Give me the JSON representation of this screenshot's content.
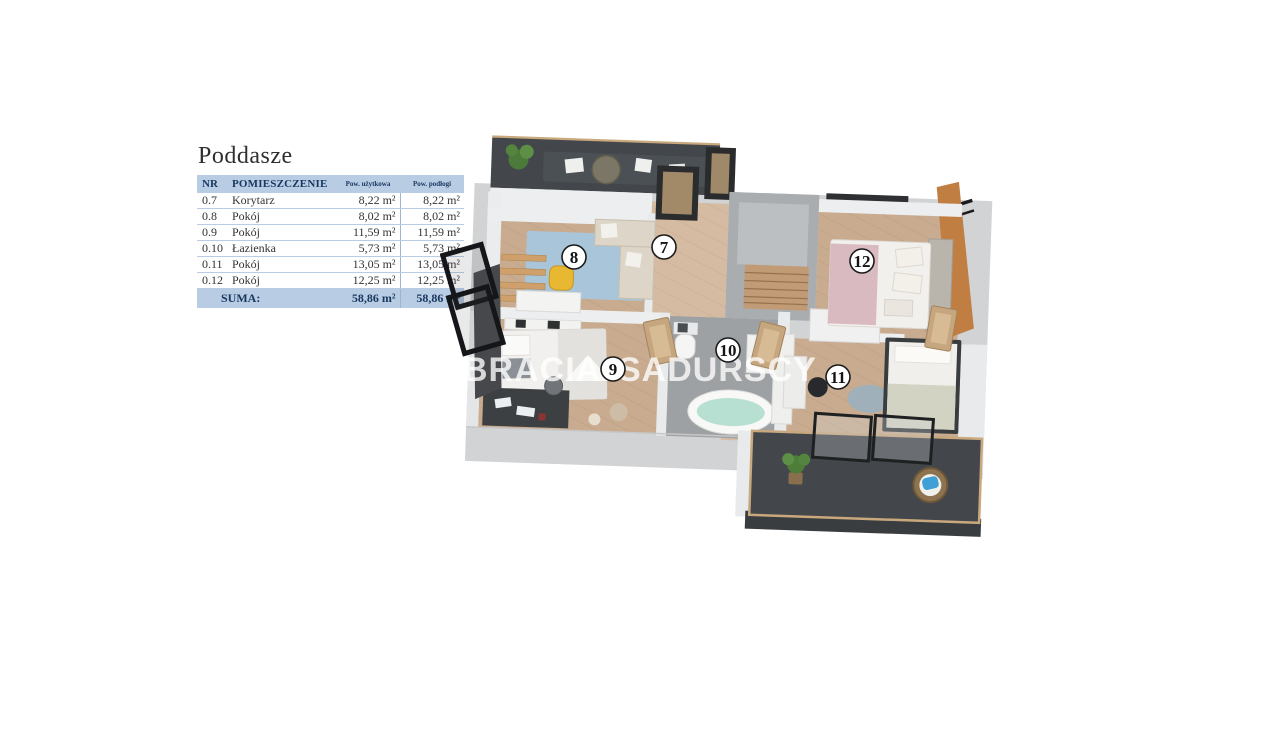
{
  "page": {
    "background": "#ffffff"
  },
  "panel": {
    "title": "Poddasze",
    "table": {
      "header": {
        "nr": "NR",
        "room": "POMIESZCZENIE",
        "usable": "Pow. użytkowa",
        "floor": "Pow. podłogi"
      },
      "rows": [
        {
          "nr": "0.7",
          "name": "Korytarz",
          "usable": "8,22 m²",
          "floor": "8,22 m²"
        },
        {
          "nr": "0.8",
          "name": "Pokój",
          "usable": "8,02 m²",
          "floor": "8,02 m²"
        },
        {
          "nr": "0.9",
          "name": "Pokój",
          "usable": "11,59 m²",
          "floor": "11,59 m²"
        },
        {
          "nr": "0.10",
          "name": "Łazienka",
          "usable": "5,73 m²",
          "floor": "5,73 m²"
        },
        {
          "nr": "0.11",
          "name": "Pokój",
          "usable": "13,05 m²",
          "floor": "13,05 m²"
        },
        {
          "nr": "0.12",
          "name": "Pokój",
          "usable": "12,25 m²",
          "floor": "12,25 m²"
        }
      ],
      "summary": {
        "label": "SUMA:",
        "usable": "58,86 m²",
        "floor": "58,86 m²"
      }
    }
  },
  "plan": {
    "watermark": {
      "word1": "BRACIA",
      "word2": "SADURSCY"
    },
    "badges": {
      "room7": "7",
      "room8": "8",
      "room9": "9",
      "room10": "10",
      "room11": "11",
      "room12": "12"
    },
    "colors": {
      "table_header_bg": "#b8cce4",
      "table_header_text": "#17375e",
      "wood_floor": "#c9ac90",
      "wood_floor_light": "#d4bba2",
      "bathroom_floor": "#9ea1a4",
      "terrace_floor": "#43464a",
      "rug_blue": "#a9c5da",
      "bathtub_mint": "#b7e0d2",
      "accent_wood_wall": "#c07e42",
      "wall_base": "#d2d3d5",
      "wall_light": "#ececee"
    }
  }
}
